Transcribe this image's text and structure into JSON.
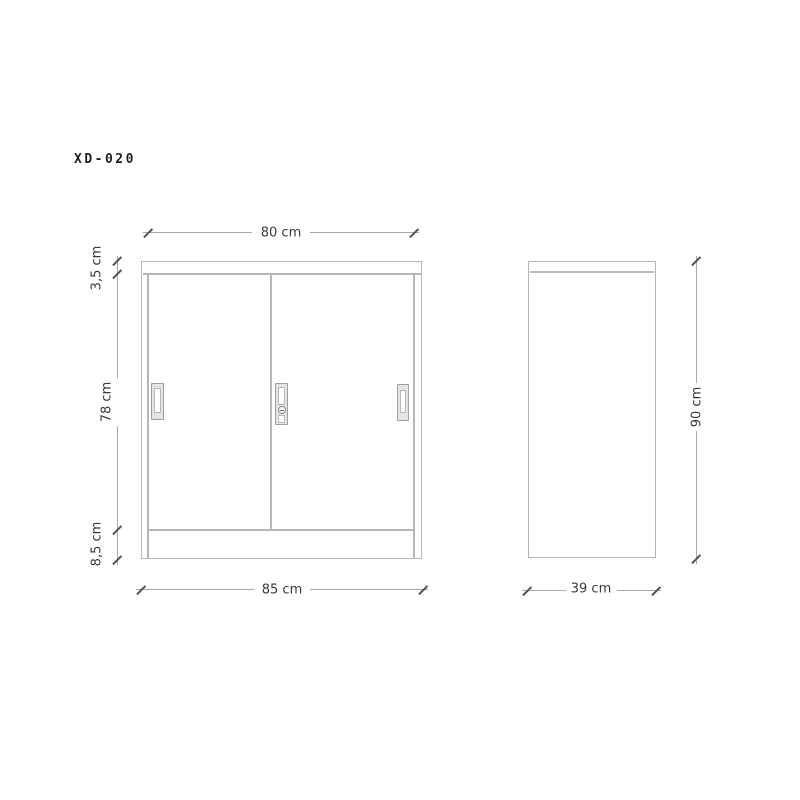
{
  "title": "XD-020",
  "front_view": {
    "top_width_label": "80 cm",
    "top_panel_label": "3,5 cm",
    "door_label": "78 cm",
    "base_label": "8,5 cm",
    "bottom_width_label": "85 cm"
  },
  "side_view": {
    "height_label": "90 cm",
    "depth_label": "39 cm"
  },
  "colors": {
    "bg": "#ffffff",
    "line": "#b6b6b6",
    "dim": "#a8a8a8",
    "tick": "#4f4f4f",
    "text": "#3a3a3a",
    "title_text": "#1f1f1f",
    "handle_fill": "#e4e4e4",
    "handle_border": "#9f9f9f"
  }
}
